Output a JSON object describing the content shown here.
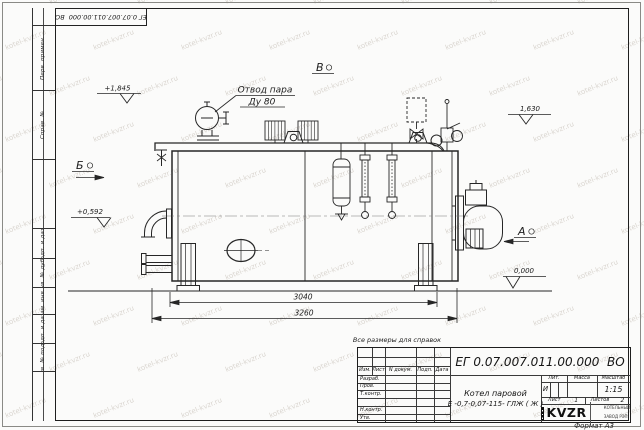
{
  "doc_number": "ЕГ 0.07.007.011.00.000  ВО",
  "sheet": {
    "watermark_text": "kotel-kvzr.ru",
    "reference_note": "Все размеры для справок",
    "format_label": "Формат А3"
  },
  "margin_columns": {
    "col1": "Перв. примен.",
    "col2": "Справ. №",
    "col3": "Подп. и дата",
    "col4": "Инв. № дубл.",
    "col5": "Взам. инв. №",
    "col6": "Подп. и дата",
    "col7": "Инв. № подл."
  },
  "drawing": {
    "steam_outlet_label_line1": "Отвод пара",
    "steam_outlet_label_line2": "Ду 80",
    "view_a": "А",
    "view_b": "Б",
    "view_v": "В",
    "elevation_marks": {
      "top_left": "+1,845",
      "top_right": "1,630",
      "mid_left": "+0,592",
      "bottom_right": "0,000"
    },
    "dimensions": {
      "inner_length": "3040",
      "overall_length": "3260"
    }
  },
  "title_block": {
    "product_line1": "Котел паровой",
    "product_line2": "Е -0,7-0,07-115- ГЛЖ ( Ж )",
    "header_izm": "Изм.",
    "header_list": "Лист",
    "header_docnum": "N докум.",
    "header_podp": "Подп.",
    "header_data": "Дата",
    "row_razrab": "Разраб.",
    "row_prov": "Пров.",
    "row_tkontr": "Т.контр.",
    "row_nkontr": "Н.контр.",
    "row_utv": "Утв.",
    "lit_label": "Лит.",
    "lit_value": "И",
    "mass_label": "Масса",
    "scale_label": "Масштаб",
    "scale_value": "1:15",
    "sheet_label": "Лист",
    "sheet_number": "1",
    "sheets_label": "Листов",
    "sheets_total": "2",
    "logo_text": "KVZR",
    "logo_caption_line1": "КОТЕЛЬНЫЙ",
    "logo_caption_line2": "ЗАВОД РЭП"
  }
}
